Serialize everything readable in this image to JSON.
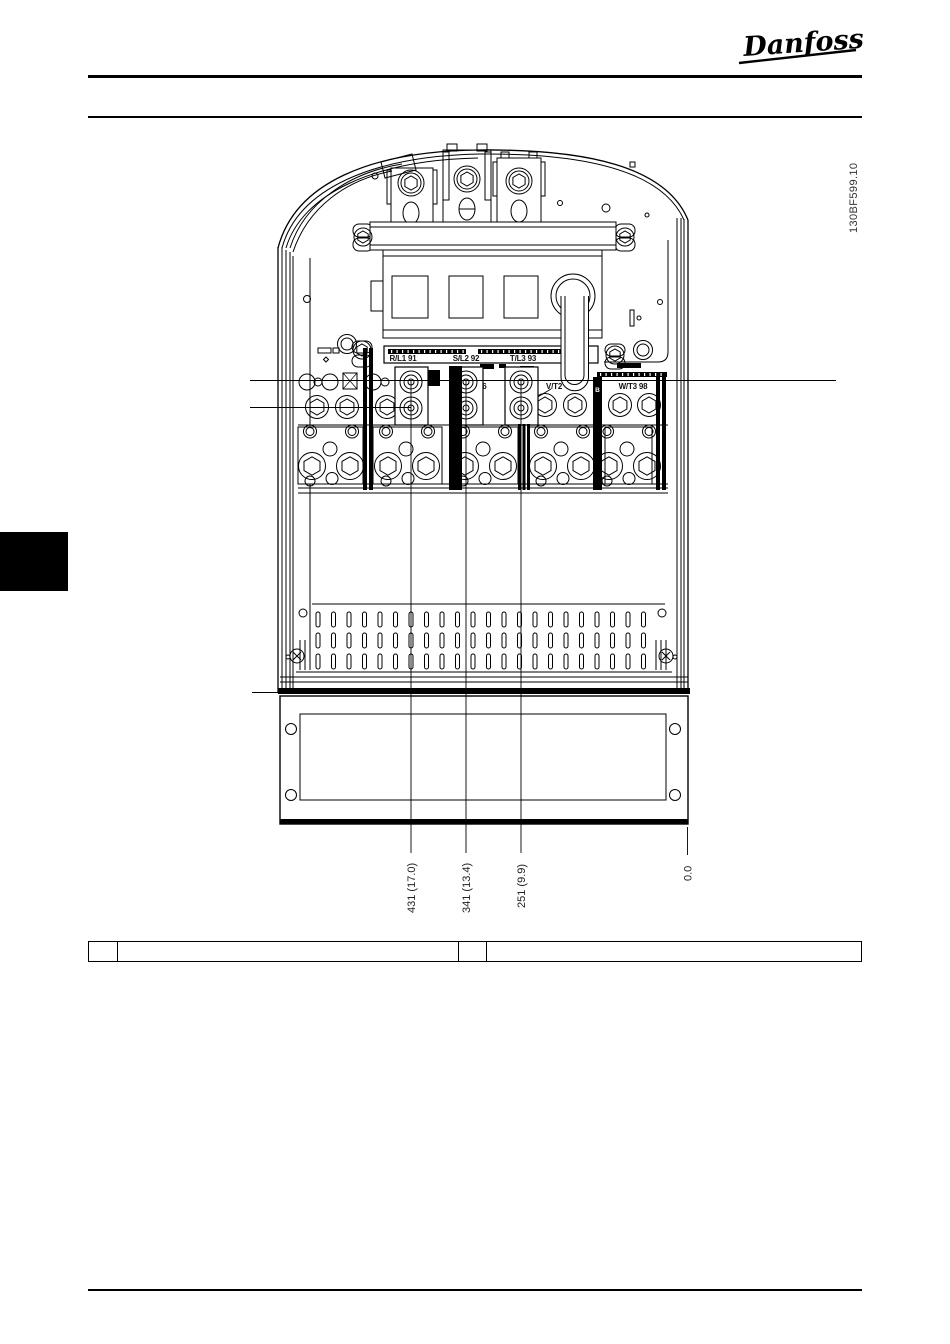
{
  "header": {
    "logo_text": "Danfoss"
  },
  "figure": {
    "code": "130BF599.10",
    "mains_terminal_labels": [
      "R/L1 91",
      "S/L2 92",
      "T/L3 93"
    ],
    "motor_terminal_labels": [
      "U/T1 96",
      "V/T2",
      "W/T3 98"
    ],
    "busbar_label": "B",
    "dimension_labels": [
      "431 (17.0)",
      "341 (13.4)",
      "251 (9.9)",
      "0.0"
    ]
  },
  "legend_table": {
    "cells": [
      "",
      "",
      "",
      ""
    ]
  }
}
